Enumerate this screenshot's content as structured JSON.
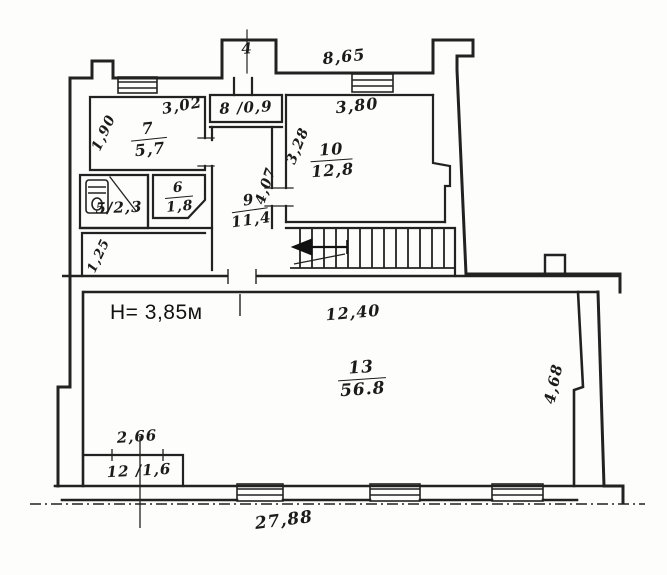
{
  "annotation": {
    "ceiling_height": "H= 3,85м"
  },
  "rooms": {
    "r4": {
      "number": "4"
    },
    "r7": {
      "number": "7",
      "area": "5,7"
    },
    "r8": {
      "label": "8 /0,9"
    },
    "r5": {
      "label": "5/2,3"
    },
    "r6": {
      "number": "6",
      "area": "1,8"
    },
    "r9": {
      "number": "9",
      "area": "11,4"
    },
    "r10": {
      "number": "10",
      "area": "12,8"
    },
    "r12": {
      "label": "12 /1,6"
    },
    "r13": {
      "number": "13",
      "area": "56.8"
    }
  },
  "dimensions": {
    "top_width": "8,65",
    "room7_width": "3,02",
    "room7_depth": "1,90",
    "room10_width": "3,80",
    "room10_depth": "3,28",
    "corridor9_depth": "4,07",
    "passage_width": "1,25",
    "hall_top_width": "12,40",
    "room12_width": "2,66",
    "hall_right_depth": "4,68",
    "bottom_width": "27,88"
  }
}
